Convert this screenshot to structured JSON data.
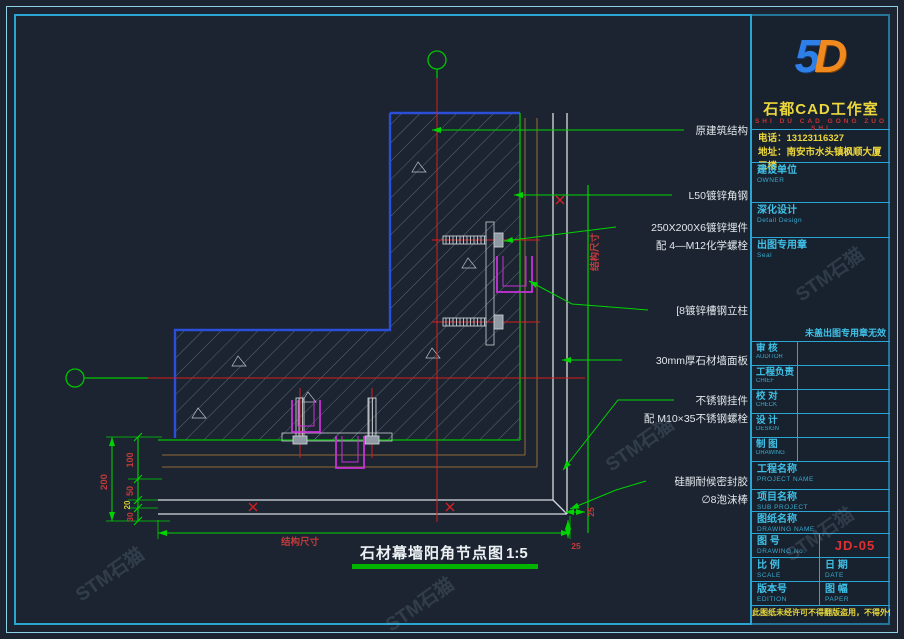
{
  "watermark": {
    "text": "STM石猫"
  },
  "drawing": {
    "title": "石材幕墙阳角节点图",
    "scale_note": "1:5",
    "axis_dim_h": "结构尺寸",
    "axis_dim_v": "结构尺寸",
    "dims": {
      "overall": "200",
      "d1": "100",
      "d2": "50",
      "d3": "20",
      "d4": "30",
      "corner_a": "25",
      "corner_b": "25"
    },
    "labels": [
      {
        "line1": "原建筑结构",
        "line2": ""
      },
      {
        "line1": "L50镀锌角钢",
        "line2": ""
      },
      {
        "line1": "250X200X6镀锌埋件",
        "line2": "配 4—M12化学螺栓"
      },
      {
        "line1": "[8镀锌槽钢立柱",
        "line2": ""
      },
      {
        "line1": "30mm厚石材墙面板",
        "line2": ""
      },
      {
        "line1": "不锈钢挂件",
        "line2": "配 M10×35不锈钢螺栓"
      },
      {
        "line1": "硅酮耐候密封胶",
        "line2": "∅8泡沫棒"
      }
    ]
  },
  "titleblock": {
    "logo": {
      "left": "5",
      "right": "D"
    },
    "studio": "石都CAD工作室",
    "pinyin": "SHI DU CAD GONG ZUO SHI",
    "phone": "电话：13123116327",
    "address": "地址：南安市水头镇枫顺大厦三楼",
    "owner": {
      "label": "建设单位",
      "sub": "OWNER"
    },
    "design": {
      "label": "深化设计",
      "sub": "Detail Design"
    },
    "seal": {
      "label": "出图专用章",
      "sub": "Seal",
      "note": "未盖出图专用章无效"
    },
    "people": [
      {
        "label": "审  核",
        "sub": "AUDITOR"
      },
      {
        "label": "工程负责",
        "sub": "CHIEF"
      },
      {
        "label": "校  对",
        "sub": "CHECK"
      },
      {
        "label": "设  计",
        "sub": "DESIGN"
      },
      {
        "label": "制  图",
        "sub": "DRAWING"
      }
    ],
    "project": {
      "label": "工程名称",
      "sub": "PROJECT NAME"
    },
    "subproject": {
      "label": "项目名称",
      "sub": "SUB PROJECT"
    },
    "dwgname": {
      "label": "图纸名称",
      "sub": "DRAWING NAME"
    },
    "dwgno": {
      "label": "图  号",
      "sub": "DRAWING No.",
      "value": "JD-05"
    },
    "scale": {
      "label": "比  例",
      "sub": "SCALE"
    },
    "date": {
      "label": "日  期",
      "sub": "DATE"
    },
    "edition": {
      "label": "版本号",
      "sub": "EDITION"
    },
    "paper": {
      "label": "图  幅",
      "sub": "PAPER"
    },
    "disclaimer": "此图纸未经许可不得翻版盗用，不得外传。"
  }
}
